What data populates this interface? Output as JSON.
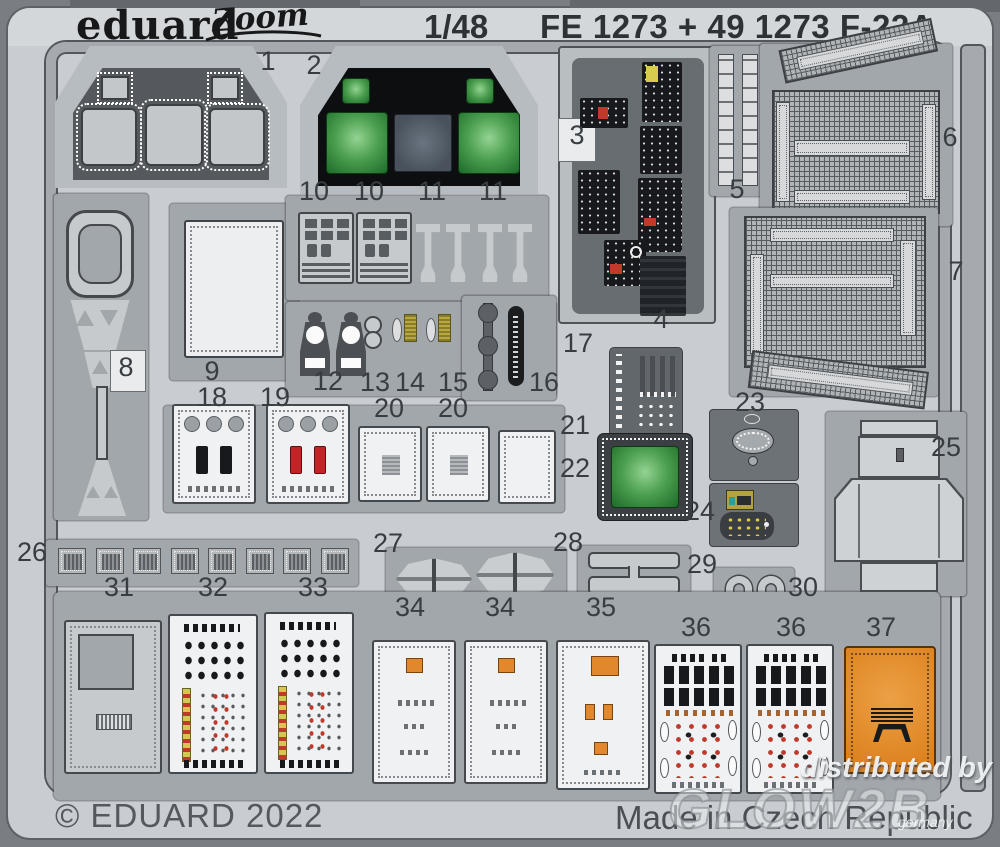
{
  "header": {
    "brand": "eduard",
    "logo_script": "Zoom",
    "scale": "1/48",
    "title": "FE 1273 + 49 1273 F-22A"
  },
  "footer": {
    "copyright": "© EDUARD 2022",
    "made_in": "Made in Czech Republic"
  },
  "watermark": {
    "line1": "distributed by",
    "line2": "GLOW2B",
    "line3": "germany"
  },
  "labels": [
    "1",
    "2",
    "3",
    "4",
    "5",
    "6",
    "7",
    "8",
    "9",
    "10",
    "10",
    "11",
    "11",
    "12",
    "13",
    "14",
    "15",
    "16",
    "17",
    "18",
    "19",
    "20",
    "20",
    "21",
    "22",
    "23",
    "24",
    "25",
    "26",
    "27",
    "28",
    "29",
    "30",
    "31",
    "32",
    "33",
    "34",
    "34",
    "35",
    "36",
    "36",
    "37"
  ],
  "colors": {
    "background": "#7a7e82",
    "sheet": "#c9cdd1",
    "frame": "#a6aaae",
    "carrier": "#a2a7ab",
    "panel_black": "#17191c",
    "screen_green": "#4b9e4f",
    "screen_gray": "#5c6670",
    "accent_red": "#c0392b",
    "accent_orange": "#e0882b",
    "accent_yellow": "#d9c552",
    "part37_orange": "#e08a28"
  }
}
